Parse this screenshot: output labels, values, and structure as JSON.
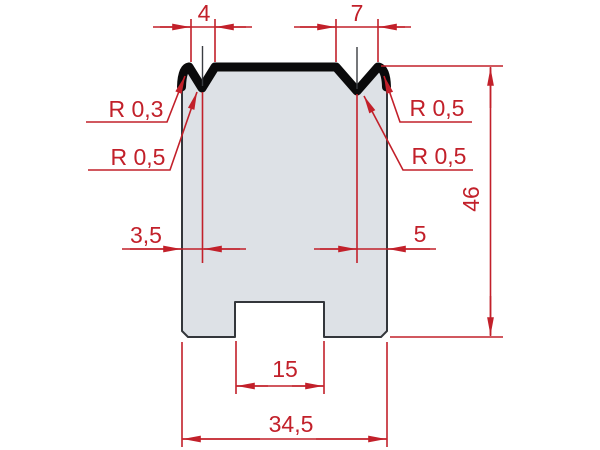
{
  "drawing": {
    "dims": {
      "v1_width": "4",
      "v2_width": "7",
      "height": "46",
      "v1_center_from_left": "3,5",
      "v2_center_from_right": "5",
      "slot_width": "15",
      "total_width": "34,5"
    },
    "radii": {
      "left_shoulder": "R 0,3",
      "left_groove": "R 0,5",
      "right_shoulder": "R 0,5",
      "right_groove": "R 0,5"
    },
    "colors": {
      "dimension_red": "#c2202a",
      "body_fill": "#dde1e6",
      "body_outline": "#33363b",
      "profile_black": "#0a0a0b",
      "background": "#ffffff"
    }
  }
}
